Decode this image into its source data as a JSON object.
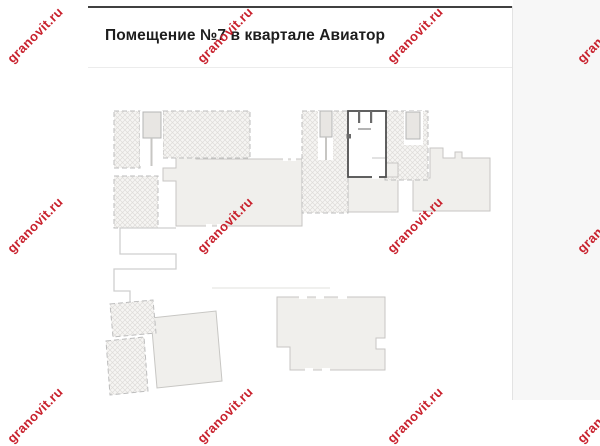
{
  "header": {
    "title": "Помещение №7 в квартале Авиатор"
  },
  "watermark": {
    "text": "granovit.ru",
    "color": "#c8202c"
  },
  "plan": {
    "highlighted_unit": "7",
    "colors": {
      "building_fill": "#f0efec",
      "building_outline": "#c7c6c3",
      "hatch_fill": "#f6f5f3",
      "hatch_line": "#dedcd9",
      "hatch_border": "#bdbdbd",
      "unit_outline": "#4f4f4f",
      "elevator_fill": "#e8e6e3",
      "card_top_border": "#404040",
      "divider": "#ececec",
      "title_text": "#1d1d1d",
      "side_background": "#f7f7f7"
    }
  }
}
